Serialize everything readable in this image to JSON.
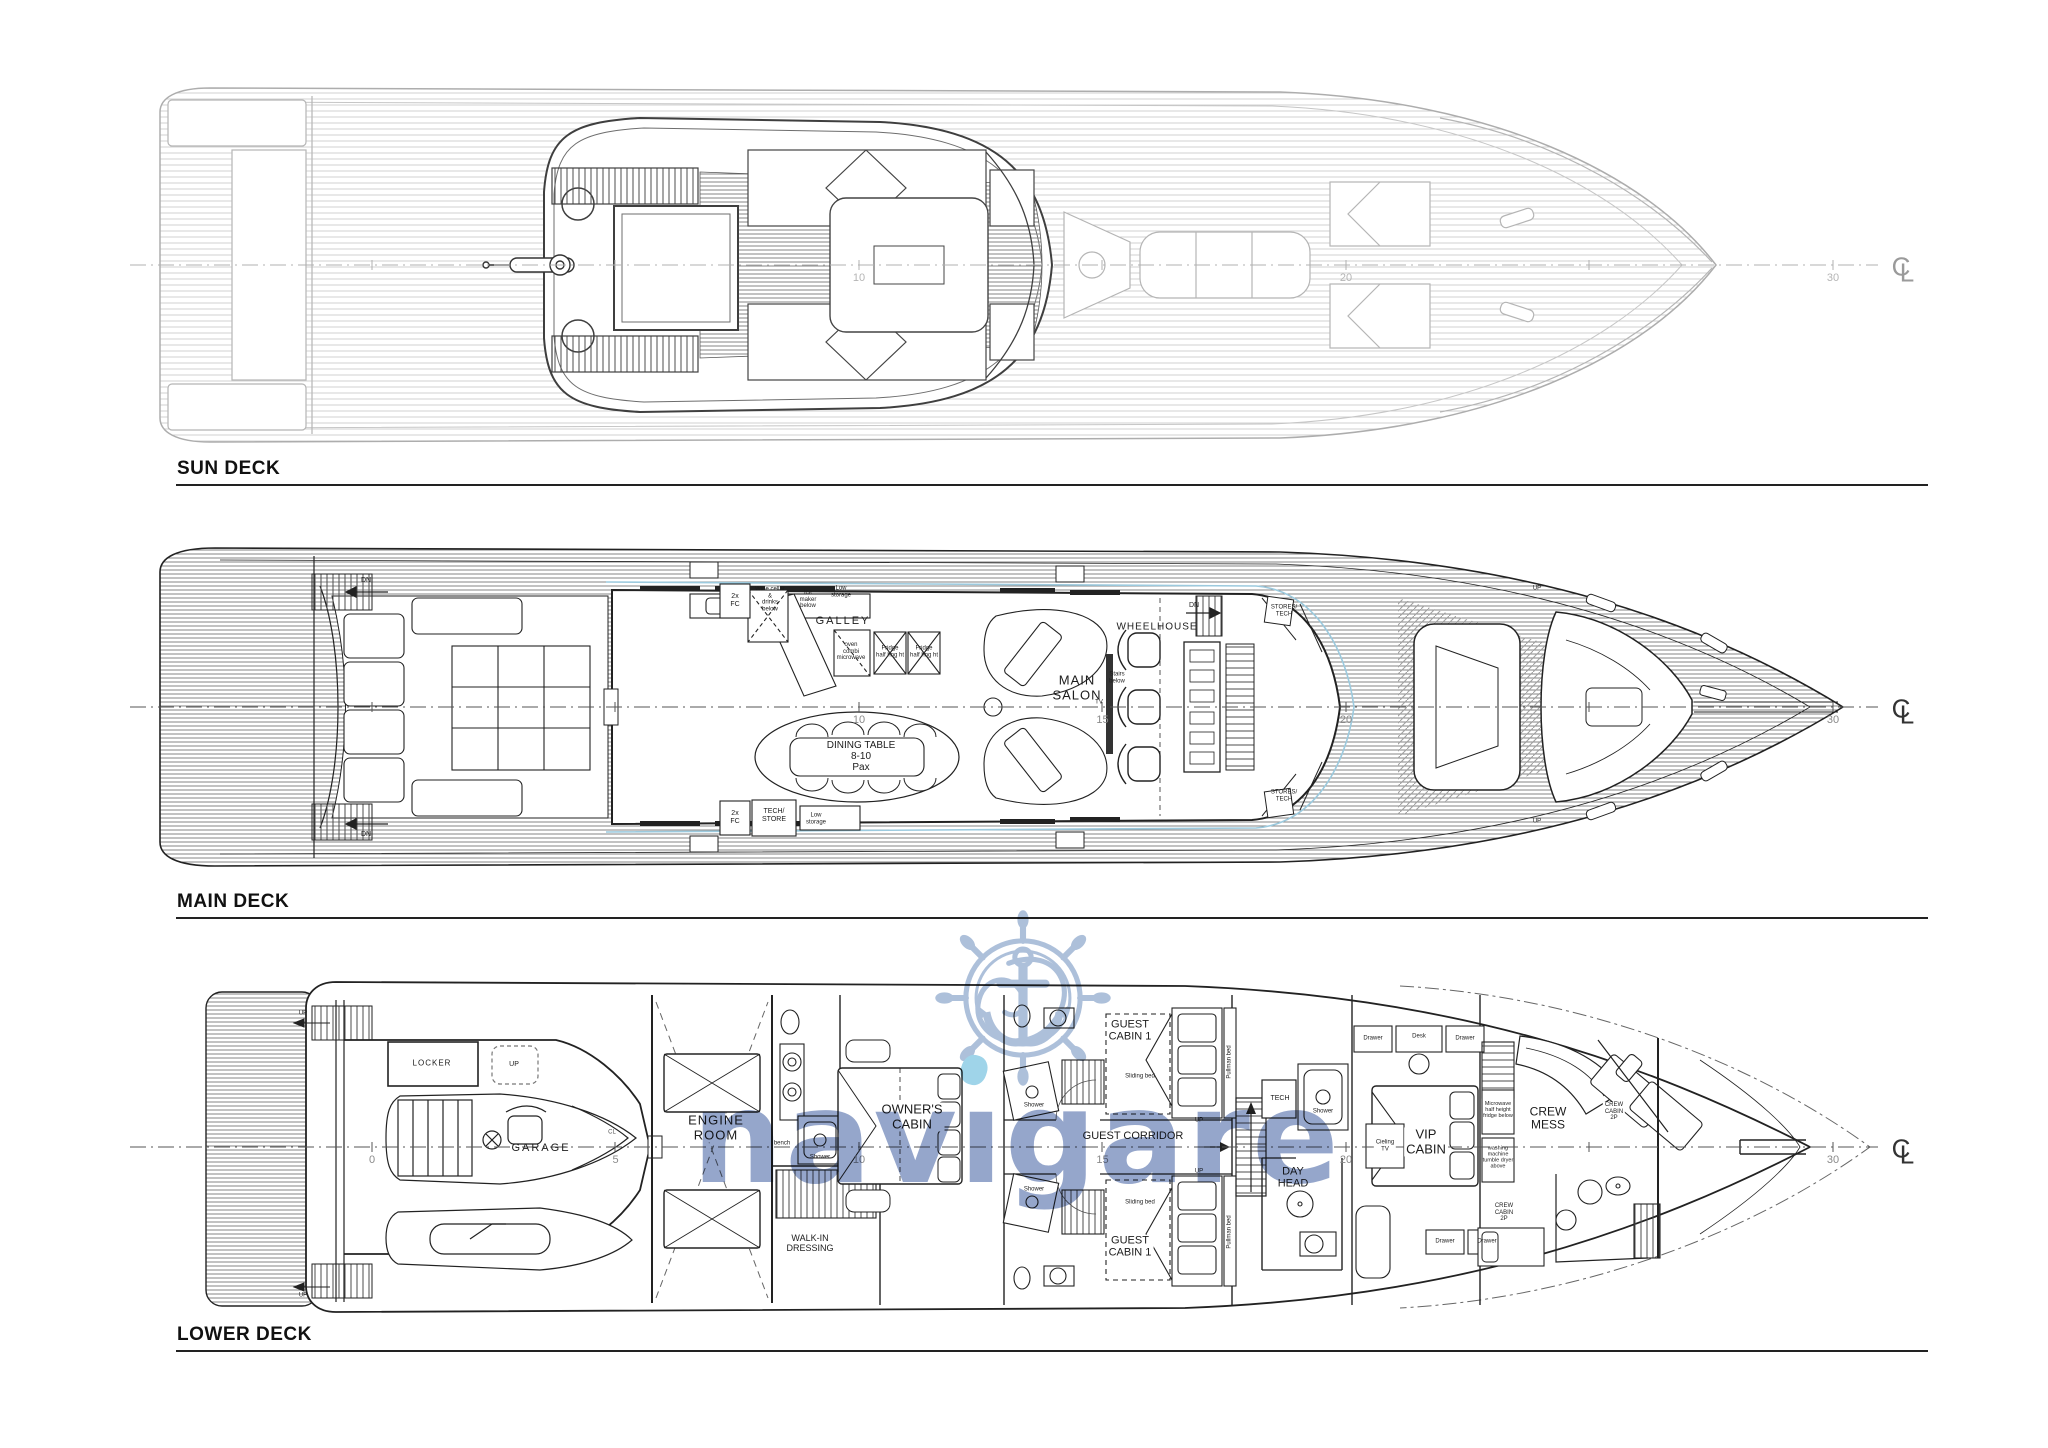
{
  "watermark": {
    "brand": "navigare",
    "brand_pre": "nav",
    "brand_i": "ı",
    "brand_post": "gare",
    "text_color": "#8296C2",
    "logo_color": "#9FB5D4",
    "dot_color": "#8ECDE6"
  },
  "decks": [
    {
      "id": "sun",
      "title": "SUN DECK",
      "scale_ticks": [
        10,
        20,
        30
      ],
      "labels": [
        {
          "t": "C",
          "x": 1901,
          "y": 267,
          "fs": 26,
          "color": "#9a9a9a",
          "name": "centerline-symbol-c"
        },
        {
          "t": "L",
          "x": 1907,
          "y": 273,
          "fs": 26,
          "color": "#9a9a9a",
          "name": "centerline-symbol-l"
        }
      ]
    },
    {
      "id": "main",
      "title": "MAIN DECK",
      "scale_ticks": [
        10,
        15,
        20,
        30
      ],
      "labels": [
        {
          "t": "GALLEY",
          "x": 843,
          "y": 621,
          "fs": 11,
          "ls": 2,
          "name": "galley-label"
        },
        {
          "t": "2x\nFC",
          "x": 735,
          "y": 601,
          "fs": 7,
          "name": "fc-box-label"
        },
        {
          "t": "2x\nFC",
          "x": 735,
          "y": 818,
          "fs": 7,
          "name": "fc-box-label"
        },
        {
          "t": "Wine cellar\n&\ndrinks\nbelow",
          "x": 770,
          "y": 600,
          "fs": 6,
          "name": "wine-cellar-label"
        },
        {
          "t": "Ice\nmaker\nbelow",
          "x": 808,
          "y": 600,
          "fs": 6,
          "name": "ice-maker-label"
        },
        {
          "t": "Low\nstorage",
          "x": 841,
          "y": 592,
          "fs": 6,
          "name": "low-storage-label"
        },
        {
          "t": "oven\ncombi\nmicrowave",
          "x": 851,
          "y": 652,
          "fs": 6,
          "name": "oven-label"
        },
        {
          "t": "Fridge\nhalf hng ht",
          "x": 890,
          "y": 652,
          "fs": 6,
          "name": "fridge-label"
        },
        {
          "t": "Fridge\nhalf hng ht",
          "x": 924,
          "y": 652,
          "fs": 6,
          "name": "fridge-label"
        },
        {
          "t": "DINING TABLE\n8-10\nPax",
          "x": 861,
          "y": 757,
          "fs": 10,
          "name": "dining-table-label"
        },
        {
          "t": "TECH/\nSTORE",
          "x": 774,
          "y": 816,
          "fs": 7,
          "name": "tech-store-label"
        },
        {
          "t": "Low\nstorage",
          "x": 816,
          "y": 819,
          "fs": 6,
          "name": "low-storage-label"
        },
        {
          "t": "MAIN\nSALON",
          "x": 1077,
          "y": 688,
          "fs": 13,
          "ls": 1,
          "name": "main-salon-label"
        },
        {
          "t": "TV",
          "x": 1099,
          "y": 703,
          "fs": 6,
          "name": "tv-label"
        },
        {
          "t": "Stairs\nbelow",
          "x": 1117,
          "y": 678,
          "fs": 6,
          "name": "stairs-below-label"
        },
        {
          "t": "WHEELHOUSE",
          "x": 1157,
          "y": 627,
          "fs": 10,
          "ls": 1,
          "name": "wheelhouse-label"
        },
        {
          "t": "DN",
          "x": 1194,
          "y": 606,
          "fs": 7,
          "name": "dn-label"
        },
        {
          "t": "STORES/\nTECH",
          "x": 1284,
          "y": 611,
          "fs": 6,
          "name": "stores-tech-label"
        },
        {
          "t": "STORES/\nTECH",
          "x": 1284,
          "y": 796,
          "fs": 6,
          "name": "stores-tech-label"
        },
        {
          "t": "DN",
          "x": 366,
          "y": 581,
          "fs": 7,
          "name": "dn-label"
        },
        {
          "t": "DN",
          "x": 366,
          "y": 835,
          "fs": 7,
          "name": "dn-label"
        },
        {
          "t": "UP",
          "x": 1537,
          "y": 589,
          "fs": 6,
          "name": "up-label"
        },
        {
          "t": "UP",
          "x": 1537,
          "y": 822,
          "fs": 6,
          "name": "up-label"
        },
        {
          "t": "C",
          "x": 1901,
          "y": 709,
          "fs": 26,
          "color": "#333",
          "name": "centerline-symbol-c"
        },
        {
          "t": "L",
          "x": 1907,
          "y": 715,
          "fs": 26,
          "color": "#333",
          "name": "centerline-symbol-l"
        }
      ]
    },
    {
      "id": "lower",
      "title": "LOWER DECK",
      "scale_ticks": [
        0,
        5,
        10,
        15,
        20,
        30
      ],
      "labels": [
        {
          "t": "LOCKER",
          "x": 432,
          "y": 1064,
          "fs": 8,
          "ls": 1,
          "name": "locker-label"
        },
        {
          "t": "UP",
          "x": 514,
          "y": 1065,
          "fs": 7,
          "name": "up-label"
        },
        {
          "t": "GARAGE",
          "x": 541,
          "y": 1148,
          "fs": 11,
          "ls": 2,
          "name": "garage-label"
        },
        {
          "t": "UP",
          "x": 303,
          "y": 1014,
          "fs": 6,
          "name": "up-label"
        },
        {
          "t": "UP",
          "x": 303,
          "y": 1296,
          "fs": 6,
          "name": "up-label"
        },
        {
          "t": "ENGINE\nROOM",
          "x": 716,
          "y": 1128,
          "fs": 13,
          "ls": 1,
          "bg": 1,
          "name": "engine-room-label"
        },
        {
          "t": "bench",
          "x": 782,
          "y": 1144,
          "fs": 6,
          "name": "bench-label"
        },
        {
          "t": "Shower",
          "x": 820,
          "y": 1158,
          "fs": 6,
          "name": "shower-label"
        },
        {
          "t": "WALK-IN\nDRESSING",
          "x": 810,
          "y": 1243,
          "fs": 9,
          "name": "walk-in-dressing-label"
        },
        {
          "t": "OWNER'S\nCABIN",
          "x": 912,
          "y": 1117,
          "fs": 13,
          "bg": 1,
          "name": "owners-cabin-label"
        },
        {
          "t": "GUEST\nCABIN 1",
          "x": 1130,
          "y": 1031,
          "fs": 11,
          "bg": 1,
          "name": "guest-cabin-label"
        },
        {
          "t": "Sliding bed",
          "x": 1140,
          "y": 1077,
          "fs": 6,
          "name": "sliding-bed-label"
        },
        {
          "t": "Pullman bed",
          "x": 1230,
          "y": 1062,
          "fs": 6,
          "rot": -90,
          "name": "pullman-bed-label"
        },
        {
          "t": "GUEST CORRIDOR",
          "x": 1133,
          "y": 1136,
          "fs": 11,
          "name": "guest-corridor-label"
        },
        {
          "t": "UP",
          "x": 1199,
          "y": 1121,
          "fs": 6,
          "name": "up-label"
        },
        {
          "t": "UP",
          "x": 1199,
          "y": 1172,
          "fs": 6,
          "name": "up-label"
        },
        {
          "t": "GUEST\nCABIN 1",
          "x": 1130,
          "y": 1247,
          "fs": 11,
          "bg": 1,
          "name": "guest-cabin-label"
        },
        {
          "t": "Sliding bed",
          "x": 1140,
          "y": 1203,
          "fs": 6,
          "name": "sliding-bed-label"
        },
        {
          "t": "Pullman bed",
          "x": 1230,
          "y": 1232,
          "fs": 6,
          "rot": -90,
          "name": "pullman-bed-label"
        },
        {
          "t": "Shower",
          "x": 1034,
          "y": 1106,
          "fs": 6,
          "name": "shower-label"
        },
        {
          "t": "Shower",
          "x": 1034,
          "y": 1190,
          "fs": 6,
          "name": "shower-label"
        },
        {
          "t": "TECH",
          "x": 1280,
          "y": 1099,
          "fs": 7,
          "name": "tech-label"
        },
        {
          "t": "Shower",
          "x": 1323,
          "y": 1112,
          "fs": 6,
          "name": "shower-label"
        },
        {
          "t": "DAY\nHEAD",
          "x": 1293,
          "y": 1178,
          "fs": 11,
          "name": "day-head-label"
        },
        {
          "t": "VIP\nCABIN",
          "x": 1426,
          "y": 1142,
          "fs": 13,
          "bg": 1,
          "name": "vip-cabin-label"
        },
        {
          "t": "Cieling\nTV",
          "x": 1385,
          "y": 1146,
          "fs": 6,
          "bg": 1,
          "name": "ceiling-tv-label"
        },
        {
          "t": "Drawer",
          "x": 1373,
          "y": 1039,
          "fs": 6,
          "name": "drawer-label"
        },
        {
          "t": "Desk",
          "x": 1419,
          "y": 1037,
          "fs": 6,
          "name": "desk-label"
        },
        {
          "t": "Drawer",
          "x": 1465,
          "y": 1039,
          "fs": 6,
          "name": "drawer-label"
        },
        {
          "t": "Drawer",
          "x": 1445,
          "y": 1242,
          "fs": 6,
          "name": "drawer-label"
        },
        {
          "t": "Drawer",
          "x": 1487,
          "y": 1242,
          "fs": 6,
          "name": "drawer-label"
        },
        {
          "t": "CREW\nMESS",
          "x": 1548,
          "y": 1119,
          "fs": 12,
          "bg": 1,
          "name": "crew-mess-label"
        },
        {
          "t": "Microwave\nhalf height\nfridge below",
          "x": 1498,
          "y": 1110,
          "fs": 5.5,
          "name": "microwave-label"
        },
        {
          "t": "washing\nmachine\ntumble dryer\nabove",
          "x": 1498,
          "y": 1158,
          "fs": 5.5,
          "name": "washing-machine-label"
        },
        {
          "t": "CREW\nCABIN\n2P",
          "x": 1614,
          "y": 1112,
          "fs": 6,
          "bg": 1,
          "name": "crew-cabin-label"
        },
        {
          "t": "CREW\nCABIN\n2P",
          "x": 1504,
          "y": 1213,
          "fs": 6,
          "bg": 1,
          "name": "crew-cabin-label"
        },
        {
          "t": "CL",
          "x": 612,
          "y": 1133,
          "fs": 6,
          "color": "#555",
          "name": "centerline-mark-small"
        },
        {
          "t": "C",
          "x": 1901,
          "y": 1149,
          "fs": 26,
          "color": "#333",
          "name": "centerline-symbol-c"
        },
        {
          "t": "L",
          "x": 1907,
          "y": 1155,
          "fs": 26,
          "color": "#333",
          "name": "centerline-symbol-l"
        }
      ]
    }
  ]
}
